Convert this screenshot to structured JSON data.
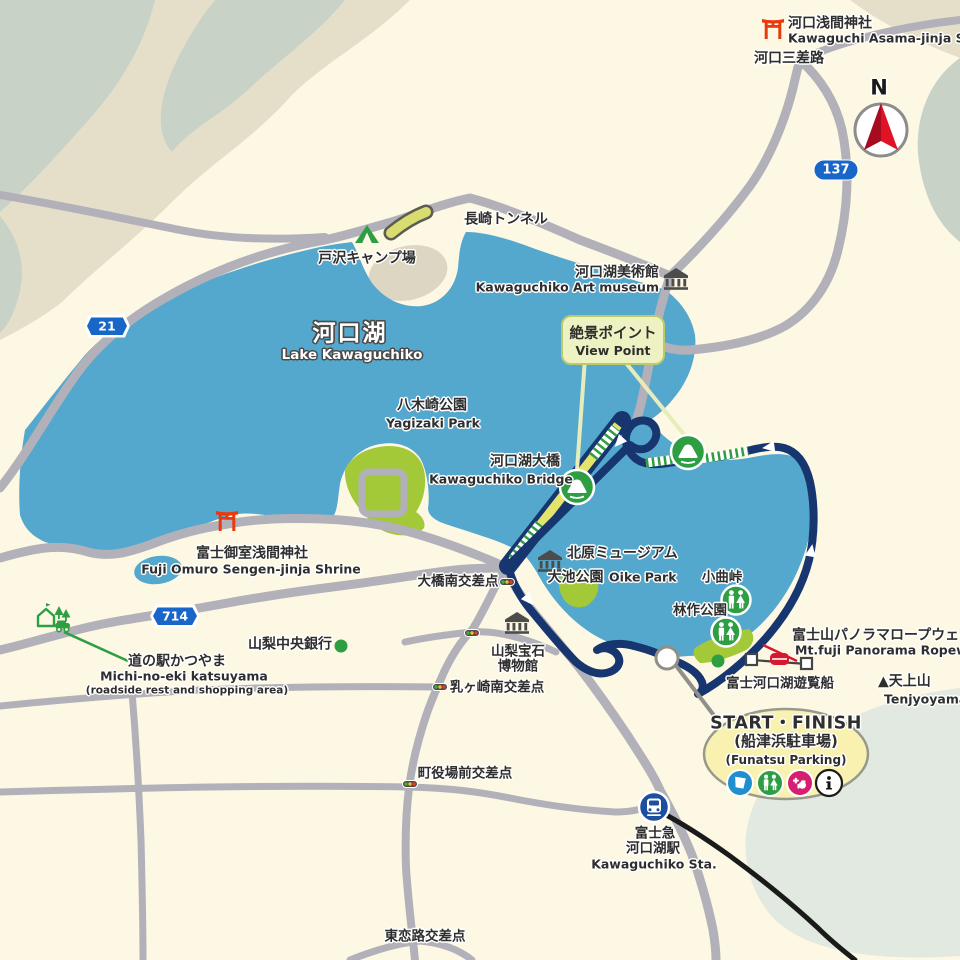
{
  "colors": {
    "background": "#fdf8e4",
    "lake": "#55a8cd",
    "course": "#17366f",
    "road": "#b2b1ba",
    "park_green": "#a3c838",
    "terrain_sage": "#c8d2c7",
    "terrain_beige": "#e5dfca",
    "marker_green": "#2e9e43",
    "badge_blue": "#1766c8",
    "torii_red": "#e8390f",
    "start_bubble_fill": "#f8f1b0",
    "railway_black": "#1a1a1a"
  },
  "compass": {
    "label": "N"
  },
  "route_badges": {
    "r137": "137",
    "r21": "21",
    "r714": "714"
  },
  "places": {
    "asama_shrine": {
      "jp": "河口浅間神社",
      "en": "Kawaguchi Asama-jinja Shrine"
    },
    "kawaguchi_sansaro": {
      "jp": "河口三差路"
    },
    "nagasaki_tunnel": {
      "jp": "長崎トンネル"
    },
    "tozawa_camp": {
      "jp": "戸沢キャンプ場"
    },
    "art_museum": {
      "jp": "河口湖美術館",
      "en": "Kawaguchiko Art museum"
    },
    "lake_kawaguchiko": {
      "jp": "河口湖",
      "en": "Lake Kawaguchiko"
    },
    "view_point": {
      "jp": "絶景ポイント",
      "en": "View Point"
    },
    "yagizaki_park": {
      "jp": "八木崎公園",
      "en": "Yagizaki Park"
    },
    "kawaguchiko_bridge": {
      "jp": "河口湖大橋",
      "en": "Kawaguchiko Bridge"
    },
    "omuro_shrine": {
      "jp": "富士御室浅間神社",
      "en": "Fuji Omuro Sengen-jinja Shrine"
    },
    "yamanashi_bank": {
      "jp": "山梨中央銀行"
    },
    "michinoeki": {
      "jp": "道の駅かつやま",
      "en": "Michi-no-eki katsuyama",
      "note": "(roadside rest and shopping area)"
    },
    "ohashi_minami": {
      "jp": "大橋南交差点"
    },
    "kitahara_museum": {
      "jp": "北原ミュージアム"
    },
    "oike_park": {
      "jp": "大池公園",
      "en": "Oike Park"
    },
    "komagari_pass": {
      "jp": "小曲峠"
    },
    "rinsaku_park": {
      "jp": "林作公園"
    },
    "gem_museum": {
      "jp_line1": "山梨宝石",
      "jp_line2": "博物館"
    },
    "chichigasaki_minami": {
      "jp": "乳ヶ崎南交差点"
    },
    "ropeway": {
      "jp": "富士山パノラマロープウェイ",
      "en": "Mt.fuji Panorama Ropeway"
    },
    "pleasure_boat": {
      "jp": "富士河口湖遊覧船"
    },
    "tenjyoyama": {
      "jp": "▲天上山",
      "en": "Tenjyoyama"
    },
    "machiyakuba_mae": {
      "jp": "町役場前交差点"
    },
    "kawaguchiko_station": {
      "jp_line1": "富士急",
      "jp_line2": "河口湖駅",
      "en": "Kawaguchiko Sta."
    },
    "higashi_koiji": {
      "jp": "東恋路交差点"
    }
  },
  "start_finish": {
    "line1": "START・FINISH",
    "line2": "(船津浜駐車場)",
    "line3": "(Funatsu Parking)"
  }
}
